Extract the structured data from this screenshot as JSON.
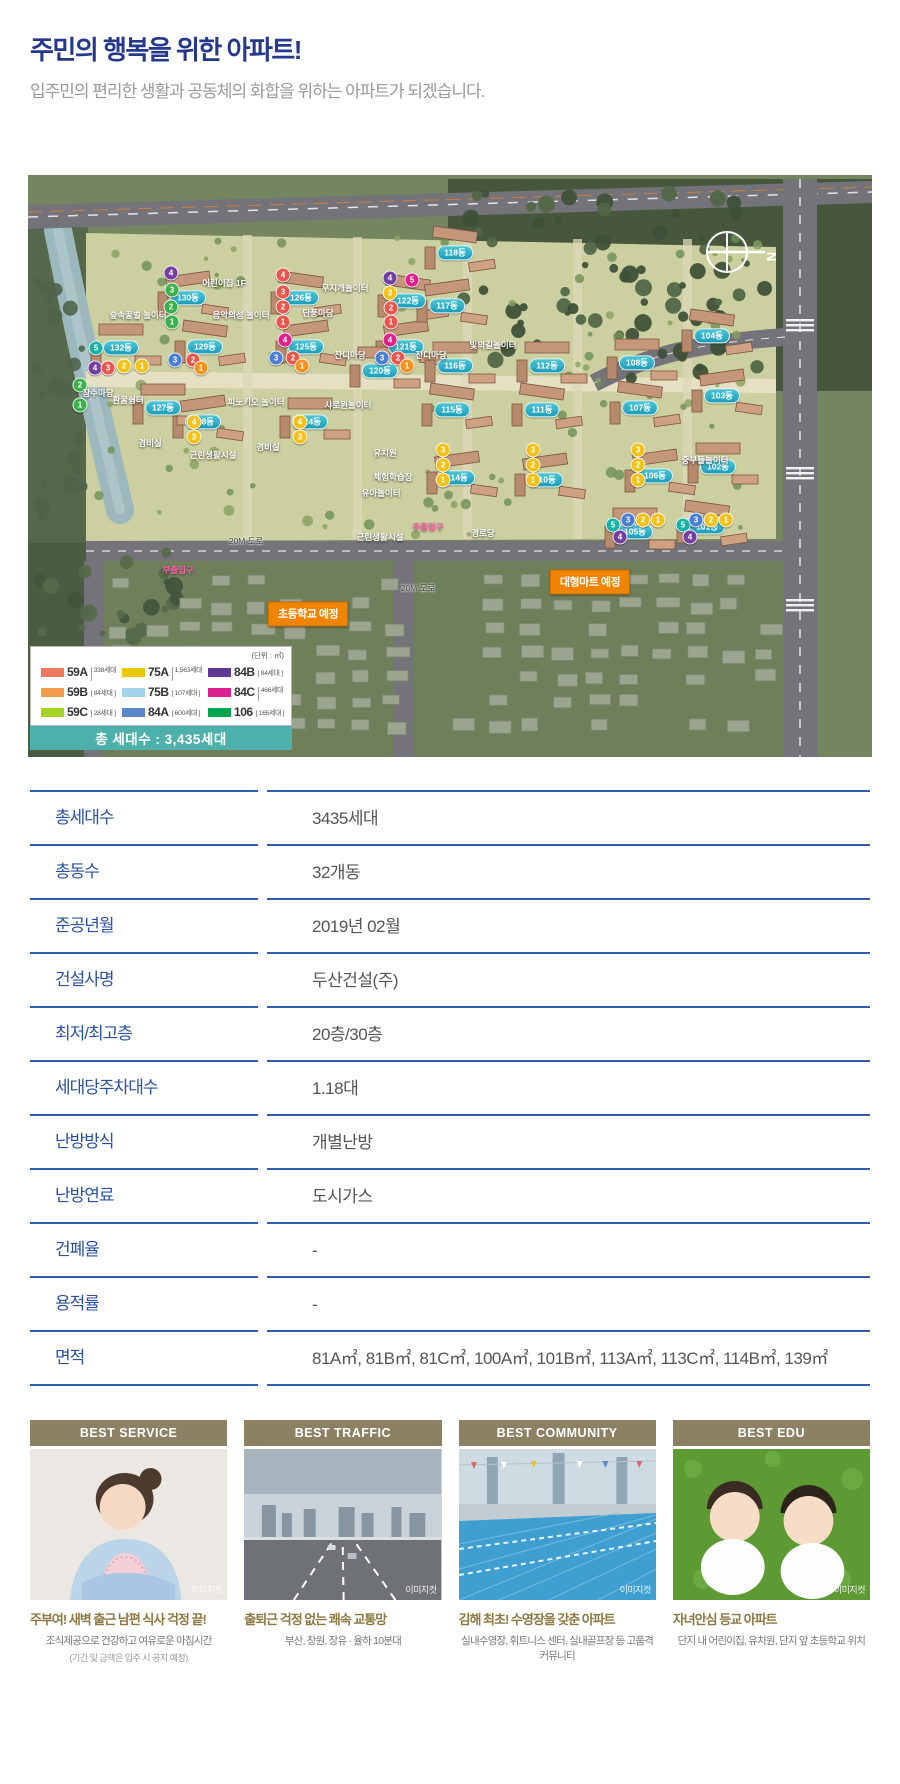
{
  "header": {
    "title": "주민의 행복을 위한 아파트!",
    "subtitle": "입주민의 편리한 생활과 공동체의 화합을 위하는 아파트가 되겠습니다."
  },
  "map": {
    "unit_note": "(단위 : ㎡)",
    "total_label": "총 세대수 : 3,435세대",
    "compass_label": "N",
    "legend": [
      {
        "label": "59A",
        "count": "[ 338세대 ]",
        "c": "#ee795f"
      },
      {
        "label": "59B",
        "count": "[ 84세대 ]",
        "c": "#f49a4b"
      },
      {
        "label": "59C",
        "count": "[ 28세대 ]",
        "c": "#a6d226"
      },
      {
        "label": "75A",
        "count": "[ 1,563세대 ]",
        "c": "#e9c90c"
      },
      {
        "label": "75B",
        "count": "[ 107세대 ]",
        "c": "#a5d3ea"
      },
      {
        "label": "84A",
        "count": "[ 600세대 ]",
        "c": "#5c88c9"
      },
      {
        "label": "84B",
        "count": "[ 84세대 ]",
        "c": "#5f3795"
      },
      {
        "label": "84C",
        "count": "[ 466세대 ]",
        "c": "#d9208e"
      },
      {
        "label": "106",
        "count": "[ 165세대 ]",
        "c": "#00a44f"
      }
    ],
    "badges": [
      {
        "text": "초등학교 예정",
        "x": 280,
        "y": 439
      },
      {
        "text": "대형마트 예정",
        "x": 562,
        "y": 407
      }
    ],
    "building_pills": [
      {
        "text": "130동",
        "x": 160,
        "y": 123
      },
      {
        "text": "132동",
        "x": 93,
        "y": 173
      },
      {
        "text": "129동",
        "x": 177,
        "y": 172
      },
      {
        "text": "128동",
        "x": 175,
        "y": 247
      },
      {
        "text": "127동",
        "x": 135,
        "y": 233
      },
      {
        "text": "126동",
        "x": 273,
        "y": 123
      },
      {
        "text": "125동",
        "x": 278,
        "y": 172
      },
      {
        "text": "124동",
        "x": 282,
        "y": 247
      },
      {
        "text": "122동",
        "x": 380,
        "y": 126
      },
      {
        "text": "121동",
        "x": 378,
        "y": 172
      },
      {
        "text": "120동",
        "x": 352,
        "y": 196
      },
      {
        "text": "118동",
        "x": 427,
        "y": 78
      },
      {
        "text": "117동",
        "x": 419,
        "y": 131
      },
      {
        "text": "116동",
        "x": 427,
        "y": 191
      },
      {
        "text": "115동",
        "x": 424,
        "y": 235
      },
      {
        "text": "114동",
        "x": 429,
        "y": 303
      },
      {
        "text": "112동",
        "x": 519,
        "y": 191
      },
      {
        "text": "111동",
        "x": 514,
        "y": 235
      },
      {
        "text": "110동",
        "x": 517,
        "y": 305
      },
      {
        "text": "108동",
        "x": 609,
        "y": 188
      },
      {
        "text": "107동",
        "x": 612,
        "y": 233
      },
      {
        "text": "106동",
        "x": 627,
        "y": 301
      },
      {
        "text": "105동",
        "x": 607,
        "y": 357
      },
      {
        "text": "104동",
        "x": 684,
        "y": 161
      },
      {
        "text": "103동",
        "x": 694,
        "y": 221
      },
      {
        "text": "102동",
        "x": 690,
        "y": 292
      },
      {
        "text": "101동",
        "x": 679,
        "y": 352
      }
    ],
    "place_labels": [
      {
        "text": "어린이집 1F",
        "x": 196,
        "y": 108
      },
      {
        "text": "숲속꿀벌 놀이터",
        "x": 110,
        "y": 140
      },
      {
        "text": "음악의성 놀이터",
        "x": 213,
        "y": 140
      },
      {
        "text": "무지개놀이터",
        "x": 317,
        "y": 113
      },
      {
        "text": "단풍마당",
        "x": 290,
        "y": 138
      },
      {
        "text": "잔디마당",
        "x": 322,
        "y": 180
      },
      {
        "text": "잔디마당",
        "x": 403,
        "y": 180
      },
      {
        "text": "환꿀쉼터",
        "x": 100,
        "y": 225
      },
      {
        "text": "피노키오 놀이터",
        "x": 228,
        "y": 227
      },
      {
        "text": "샤로윈놀이터",
        "x": 320,
        "y": 230
      },
      {
        "text": "장수마당",
        "x": 70,
        "y": 218
      },
      {
        "text": "경비실",
        "x": 122,
        "y": 268
      },
      {
        "text": "근린생활시설",
        "x": 185,
        "y": 280
      },
      {
        "text": "경비실",
        "x": 240,
        "y": 272
      },
      {
        "text": "유치원",
        "x": 357,
        "y": 278
      },
      {
        "text": "체험학습장",
        "x": 365,
        "y": 302
      },
      {
        "text": "유아놀이터",
        "x": 353,
        "y": 318
      },
      {
        "text": "근린생활시설",
        "x": 352,
        "y": 362
      },
      {
        "text": "경로당",
        "x": 455,
        "y": 358
      },
      {
        "text": "빛의길놀이터",
        "x": 465,
        "y": 170
      },
      {
        "text": "중부들놀이터",
        "x": 677,
        "y": 285
      },
      {
        "text": "주출입구",
        "x": 400,
        "y": 352,
        "cls": "pink"
      },
      {
        "text": "부출입구",
        "x": 150,
        "y": 395,
        "cls": "pink"
      },
      {
        "text": "20M 도로",
        "x": 218,
        "y": 366,
        "cls": "road"
      },
      {
        "text": "20M 도로",
        "x": 390,
        "y": 413,
        "cls": "road"
      }
    ],
    "markers": [
      {
        "n": 4,
        "c": "#7440a0",
        "x": 143,
        "y": 98
      },
      {
        "n": 3,
        "c": "#3cb04d",
        "x": 144,
        "y": 115
      },
      {
        "n": 2,
        "c": "#3cb04d",
        "x": 143,
        "y": 132
      },
      {
        "n": 1,
        "c": "#3cb04d",
        "x": 144,
        "y": 147
      },
      {
        "n": 5,
        "c": "#19b2a6",
        "x": 68,
        "y": 173
      },
      {
        "n": 4,
        "c": "#7440a0",
        "x": 67,
        "y": 193
      },
      {
        "n": 3,
        "c": "#e8564e",
        "x": 80,
        "y": 193
      },
      {
        "n": 2,
        "c": "#f3c218",
        "x": 96,
        "y": 191
      },
      {
        "n": 1,
        "c": "#f3c218",
        "x": 114,
        "y": 191
      },
      {
        "n": 3,
        "c": "#4a7fd4",
        "x": 147,
        "y": 185
      },
      {
        "n": 2,
        "c": "#e8564e",
        "x": 165,
        "y": 185
      },
      {
        "n": 1,
        "c": "#f5921e",
        "x": 173,
        "y": 193
      },
      {
        "n": 2,
        "c": "#3cb04d",
        "x": 52,
        "y": 210
      },
      {
        "n": 1,
        "c": "#3cb04d",
        "x": 52,
        "y": 230
      },
      {
        "n": 4,
        "c": "#e8564e",
        "x": 255,
        "y": 100
      },
      {
        "n": 3,
        "c": "#e8564e",
        "x": 255,
        "y": 117
      },
      {
        "n": 2,
        "c": "#e8564e",
        "x": 255,
        "y": 132
      },
      {
        "n": 1,
        "c": "#e8564e",
        "x": 255,
        "y": 147
      },
      {
        "n": 4,
        "c": "#e0218a",
        "x": 257,
        "y": 165
      },
      {
        "n": 3,
        "c": "#4a7fd4",
        "x": 248,
        "y": 183
      },
      {
        "n": 2,
        "c": "#e8564e",
        "x": 265,
        "y": 183
      },
      {
        "n": 1,
        "c": "#f5921e",
        "x": 274,
        "y": 191
      },
      {
        "n": 4,
        "c": "#7440a0",
        "x": 362,
        "y": 103
      },
      {
        "n": 5,
        "c": "#e0218a",
        "x": 384,
        "y": 105
      },
      {
        "n": 3,
        "c": "#f3c218",
        "x": 362,
        "y": 118
      },
      {
        "n": 2,
        "c": "#e8564e",
        "x": 363,
        "y": 133
      },
      {
        "n": 1,
        "c": "#e8564e",
        "x": 363,
        "y": 147
      },
      {
        "n": 4,
        "c": "#e0218a",
        "x": 362,
        "y": 165
      },
      {
        "n": 3,
        "c": "#4a7fd4",
        "x": 354,
        "y": 183
      },
      {
        "n": 2,
        "c": "#e8564e",
        "x": 370,
        "y": 183
      },
      {
        "n": 1,
        "c": "#f5921e",
        "x": 379,
        "y": 191
      },
      {
        "n": 4,
        "c": "#f3c218",
        "x": 166,
        "y": 247
      },
      {
        "n": 3,
        "c": "#f3c218",
        "x": 166,
        "y": 262
      },
      {
        "n": 4,
        "c": "#f3c218",
        "x": 272,
        "y": 247
      },
      {
        "n": 3,
        "c": "#f3c218",
        "x": 272,
        "y": 262
      },
      {
        "n": 3,
        "c": "#f3c218",
        "x": 415,
        "y": 275
      },
      {
        "n": 2,
        "c": "#f3c218",
        "x": 415,
        "y": 290
      },
      {
        "n": 1,
        "c": "#f3c218",
        "x": 415,
        "y": 305
      },
      {
        "n": 3,
        "c": "#f3c218",
        "x": 505,
        "y": 275
      },
      {
        "n": 2,
        "c": "#f3c218",
        "x": 505,
        "y": 290
      },
      {
        "n": 1,
        "c": "#f3c218",
        "x": 505,
        "y": 305
      },
      {
        "n": 3,
        "c": "#f3c218",
        "x": 610,
        "y": 275
      },
      {
        "n": 2,
        "c": "#f3c218",
        "x": 610,
        "y": 290
      },
      {
        "n": 1,
        "c": "#f3c218",
        "x": 610,
        "y": 305
      },
      {
        "n": 5,
        "c": "#19b2a6",
        "x": 585,
        "y": 350
      },
      {
        "n": 3,
        "c": "#4a7fd4",
        "x": 600,
        "y": 345
      },
      {
        "n": 2,
        "c": "#f3c218",
        "x": 615,
        "y": 345
      },
      {
        "n": 1,
        "c": "#f3c218",
        "x": 630,
        "y": 345
      },
      {
        "n": 4,
        "c": "#7440a0",
        "x": 592,
        "y": 362
      },
      {
        "n": 5,
        "c": "#19b2a6",
        "x": 655,
        "y": 350
      },
      {
        "n": 3,
        "c": "#4a7fd4",
        "x": 668,
        "y": 345
      },
      {
        "n": 2,
        "c": "#f3c218",
        "x": 683,
        "y": 345
      },
      {
        "n": 1,
        "c": "#f3c218",
        "x": 698,
        "y": 345
      },
      {
        "n": 4,
        "c": "#7440a0",
        "x": 662,
        "y": 362
      }
    ]
  },
  "table": {
    "rows": [
      {
        "label": "총세대수",
        "value": "3435세대"
      },
      {
        "label": "총동수",
        "value": "32개동"
      },
      {
        "label": "준공년월",
        "value": "2019년 02월"
      },
      {
        "label": "건설사명",
        "value": "두산건설(주)"
      },
      {
        "label": "최저/최고층",
        "value": "20층/30층"
      },
      {
        "label": "세대당주차대수",
        "value": "1.18대"
      },
      {
        "label": "난방방식",
        "value": "개별난방"
      },
      {
        "label": "난방연료",
        "value": "도시가스"
      },
      {
        "label": "건폐율",
        "value": "-"
      },
      {
        "label": "용적률",
        "value": "-"
      },
      {
        "label": "면적",
        "value": "81A㎡, 81B㎡, 81C㎡, 100A㎡, 101B㎡, 113A㎡, 113C㎡, 114B㎡, 139㎡"
      }
    ]
  },
  "cards": [
    {
      "header": "BEST SERVICE",
      "title": "주부여! 새벽 출근 남편 식사 걱정 끝!",
      "desc": "조식제공으로 건강하고 여유로운 아침시간",
      "note": "(기간 및 금액은 입주 시 공지 예정)",
      "watermark": "이미지컷"
    },
    {
      "header": "BEST TRAFFIC",
      "title": "출퇴근 걱정 없는 쾌속 교통망",
      "desc": "부산, 창원, 장유 · 율하 10분대",
      "note": "",
      "watermark": "이미지컷"
    },
    {
      "header": "BEST COMMUNITY",
      "title": "김해 최초! 수영장을 갖춘 아파트",
      "desc": "실내수영장, 휘트니스 센터, 실내골프장 등 고품격 커뮤니티",
      "note": "",
      "watermark": "이미지컷"
    },
    {
      "header": "BEST EDU",
      "title": "자녀안심 등교 아파트",
      "desc": "단지 내 어린이집, 유치원, 단지 앞 초등학교 위치",
      "note": "",
      "watermark": "이미지컷"
    }
  ]
}
